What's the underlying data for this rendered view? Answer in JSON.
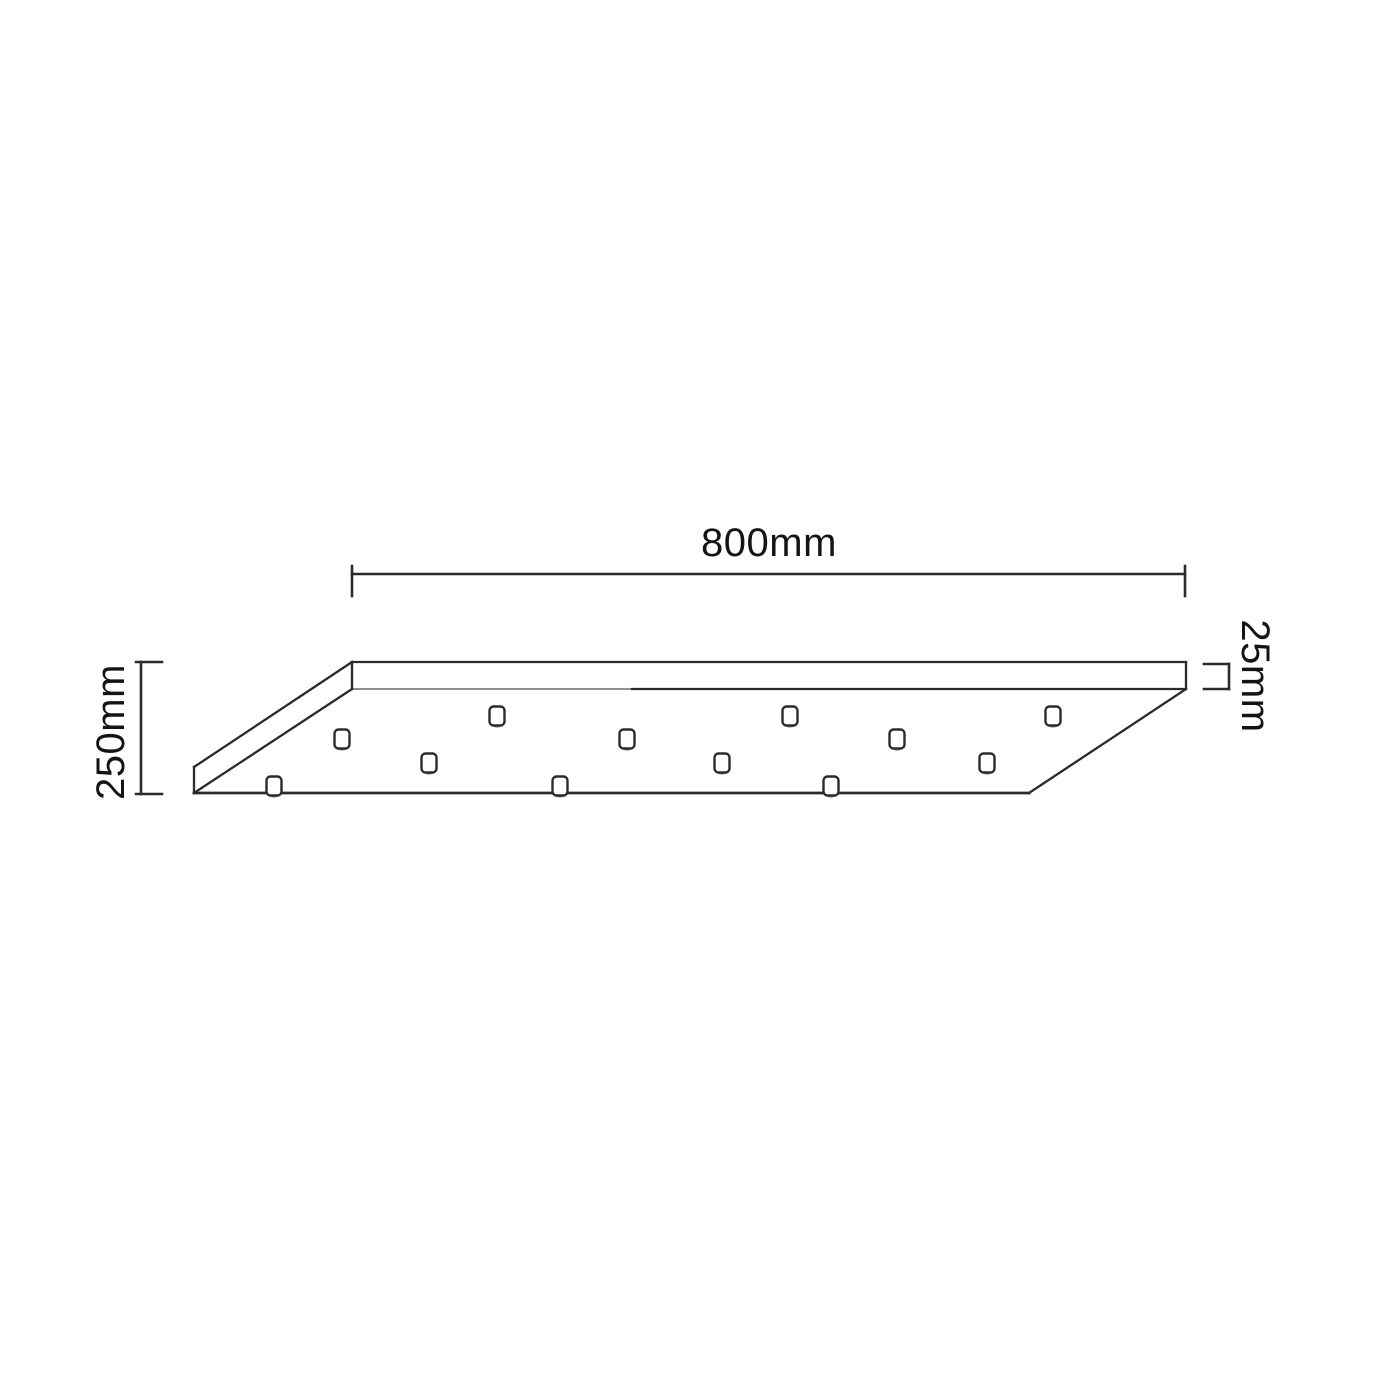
{
  "drawing": {
    "type": "technical-dimension-diagram",
    "subject": "rectangular ceiling canopy plate, oblique view, with cable holes",
    "labels": {
      "width": "800mm",
      "depth": "250mm",
      "thickness": "25mm"
    },
    "holes": {
      "count": 12,
      "size": {
        "w": 15,
        "h": 19
      },
      "centers": [
        {
          "x": 497,
          "y": 716
        },
        {
          "x": 790,
          "y": 716
        },
        {
          "x": 1053,
          "y": 716
        },
        {
          "x": 342,
          "y": 739
        },
        {
          "x": 627,
          "y": 739
        },
        {
          "x": 897,
          "y": 739
        },
        {
          "x": 429,
          "y": 763
        },
        {
          "x": 722,
          "y": 763
        },
        {
          "x": 987,
          "y": 763
        },
        {
          "x": 274,
          "y": 786
        },
        {
          "x": 560,
          "y": 786
        },
        {
          "x": 831,
          "y": 786
        }
      ]
    },
    "colors": {
      "background": "#ffffff",
      "line": "#2b2b2b",
      "line_light": "#8f8f8f",
      "text": "#141414",
      "hole_rim": "#9b9b9b"
    }
  }
}
